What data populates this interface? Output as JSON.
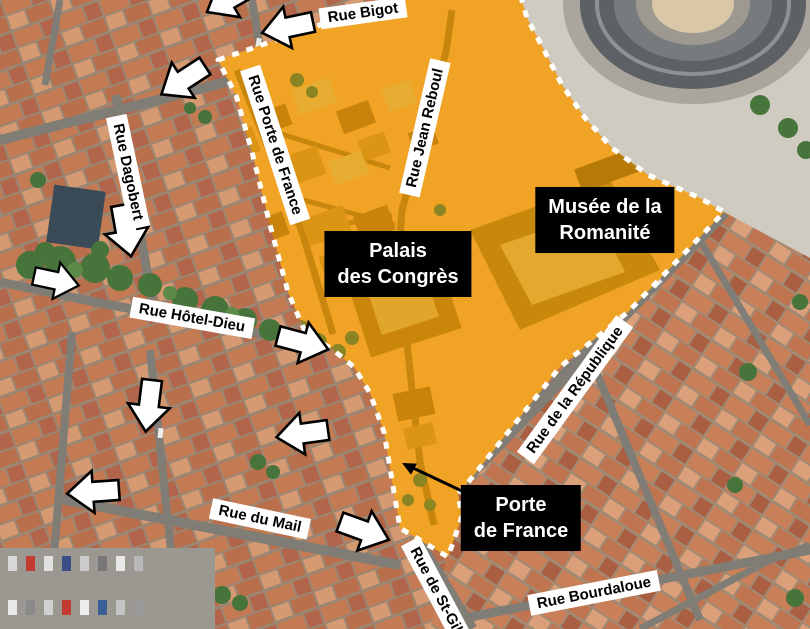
{
  "map_annotations": {
    "landmarks": [
      {
        "id": "palais-des-congres",
        "line1": "Palais",
        "line2": "des Congrès"
      },
      {
        "id": "musee-de-la-romanite",
        "line1": "Musée de la",
        "line2": "Romanité"
      },
      {
        "id": "porte-de-france",
        "line1": "Porte",
        "line2": "de France"
      }
    ],
    "streets": [
      {
        "id": "rue-bigot",
        "text": "Rue Bigot"
      },
      {
        "id": "rue-porte-de-france",
        "text": "Rue Porte de France"
      },
      {
        "id": "rue-jean-reboul",
        "text": "Rue Jean Reboul"
      },
      {
        "id": "rue-dagobert",
        "text": "Rue Dagobert"
      },
      {
        "id": "rue-hotel-dieu",
        "text": "Rue Hôtel-Dieu"
      },
      {
        "id": "rue-du-mail",
        "text": "Rue du Mail"
      },
      {
        "id": "rue-de-la-republique",
        "text": "Rue de la République"
      },
      {
        "id": "rue-de-st-gilles",
        "text": "Rue de St-Gil"
      },
      {
        "id": "rue-bourdaloue",
        "text": "Rue Bourdaloue"
      }
    ],
    "direction_arrows": [
      {
        "id": "arrow-top-clipped",
        "points_toward": "southwest"
      },
      {
        "id": "arrow-rue-bigot",
        "points_toward": "west"
      },
      {
        "id": "arrow-top-left",
        "points_toward": "southwest"
      },
      {
        "id": "arrow-rue-dagobert",
        "points_toward": "south"
      },
      {
        "id": "arrow-left-middle",
        "points_toward": "east"
      },
      {
        "id": "arrow-rue-hotel-dieu",
        "points_toward": "east"
      },
      {
        "id": "arrow-center",
        "points_toward": "south"
      },
      {
        "id": "arrow-mid-west",
        "points_toward": "west"
      },
      {
        "id": "arrow-rue-du-mail-west",
        "points_toward": "west"
      },
      {
        "id": "arrow-rue-du-mail-east",
        "points_toward": "east"
      }
    ],
    "pointer_arrow_target": "porte-de-france-gate",
    "colors": {
      "highlight_zone": "#F0A325",
      "zone_border": "#FFFFFF",
      "landmark_box_bg": "#000000",
      "landmark_box_text": "#FFFFFF",
      "street_label_bg": "#FFFFFF",
      "street_label_text": "#000000",
      "direction_arrow_fill": "#FFFFFF",
      "direction_arrow_outline": "#000000",
      "pointer_arrow": "#000000"
    }
  }
}
